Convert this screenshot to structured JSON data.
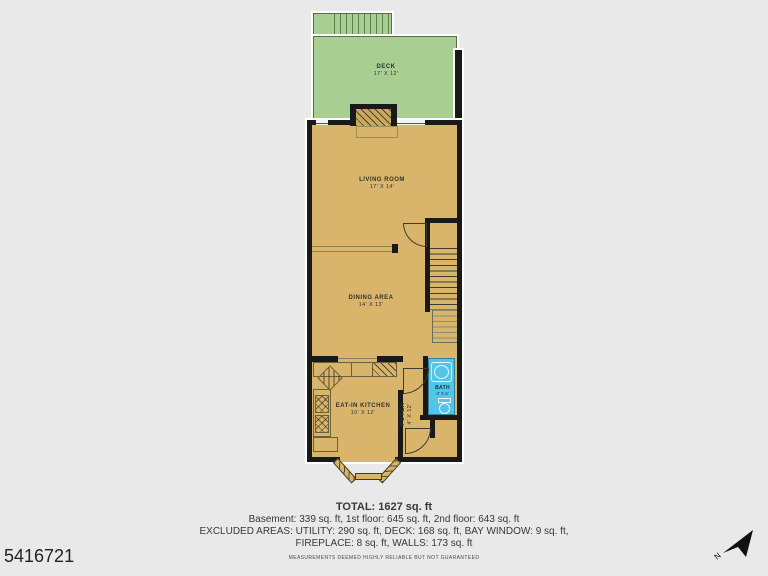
{
  "listing_id": "5416721",
  "rooms": {
    "deck": {
      "name": "DECK",
      "dims": "17' X 12'"
    },
    "living": {
      "name": "LIVING ROOM",
      "dims": "17' X 14'"
    },
    "dining": {
      "name": "DINING AREA",
      "dims": "14' X 13'"
    },
    "kitchen": {
      "name": "EAT-IN KITCHEN",
      "dims": "10' X 12'"
    },
    "bath": {
      "name": "BATH",
      "dims": "3' X 6'"
    },
    "foyer": {
      "name": "FOYER",
      "dims": "4' X 12'"
    }
  },
  "summary": {
    "total": "TOTAL: 1627 sq. ft",
    "floors": "Basement: 339 sq. ft, 1st floor: 645 sq. ft, 2nd floor: 643 sq. ft",
    "excluded1": "EXCLUDED AREAS: UTILITY: 290 sq. ft, DECK: 168 sq. ft, BAY WINDOW: 9 sq. ft,",
    "excluded2": "FIREPLACE: 8 sq. ft, WALLS: 173 sq. ft",
    "disclaimer": "MEASUREMENTS DEEMED HIGHLY RELIABLE BUT NOT GUARANTEED"
  },
  "compass": {
    "label": "N"
  },
  "colors": {
    "deck_green": "#a8ce91",
    "floor_tan": "#d9b56c",
    "bath_blue": "#52c6e8",
    "wall_black": "#191919",
    "background": "#e9e9e9"
  }
}
